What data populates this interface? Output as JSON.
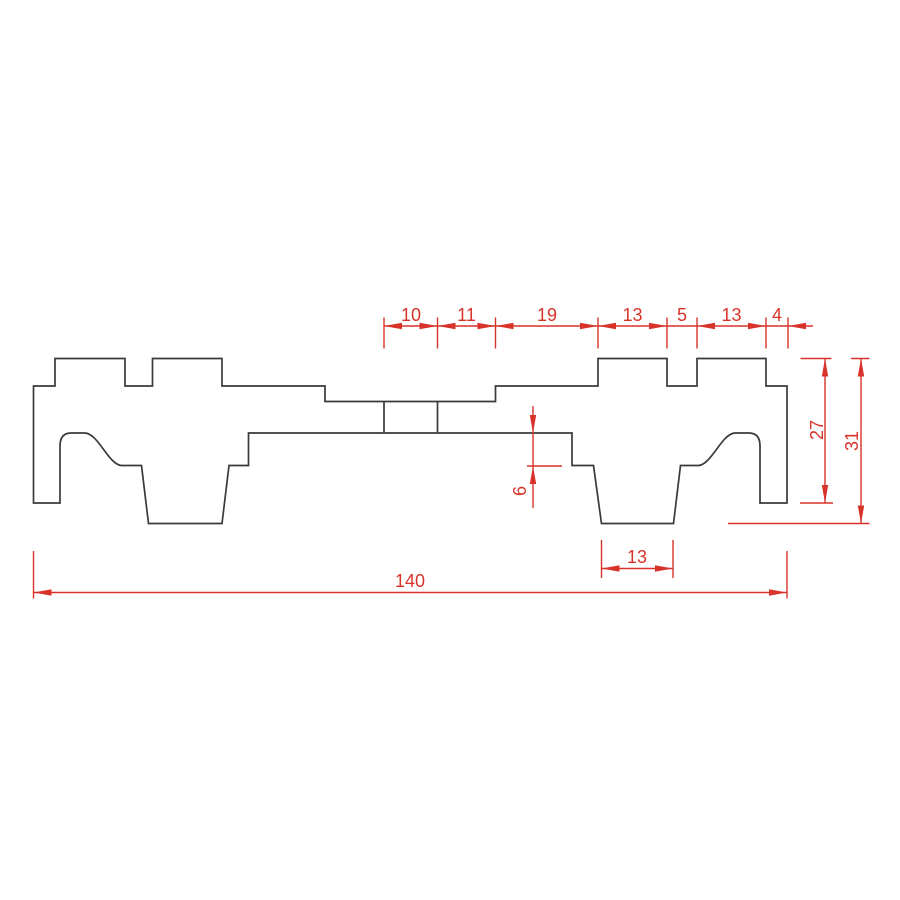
{
  "drawing": {
    "kind": "technical-cross-section",
    "colors": {
      "outline": "#3a3a3a",
      "dimension": "#d8332a",
      "background": "#ffffff"
    },
    "dimensions": {
      "top_chain": [
        "10",
        "11",
        "19",
        "13",
        "5",
        "13",
        "4"
      ],
      "step_depth": "6",
      "height_partial": "27",
      "height_total": "31",
      "foot_width": "13",
      "total_width": "140"
    }
  }
}
